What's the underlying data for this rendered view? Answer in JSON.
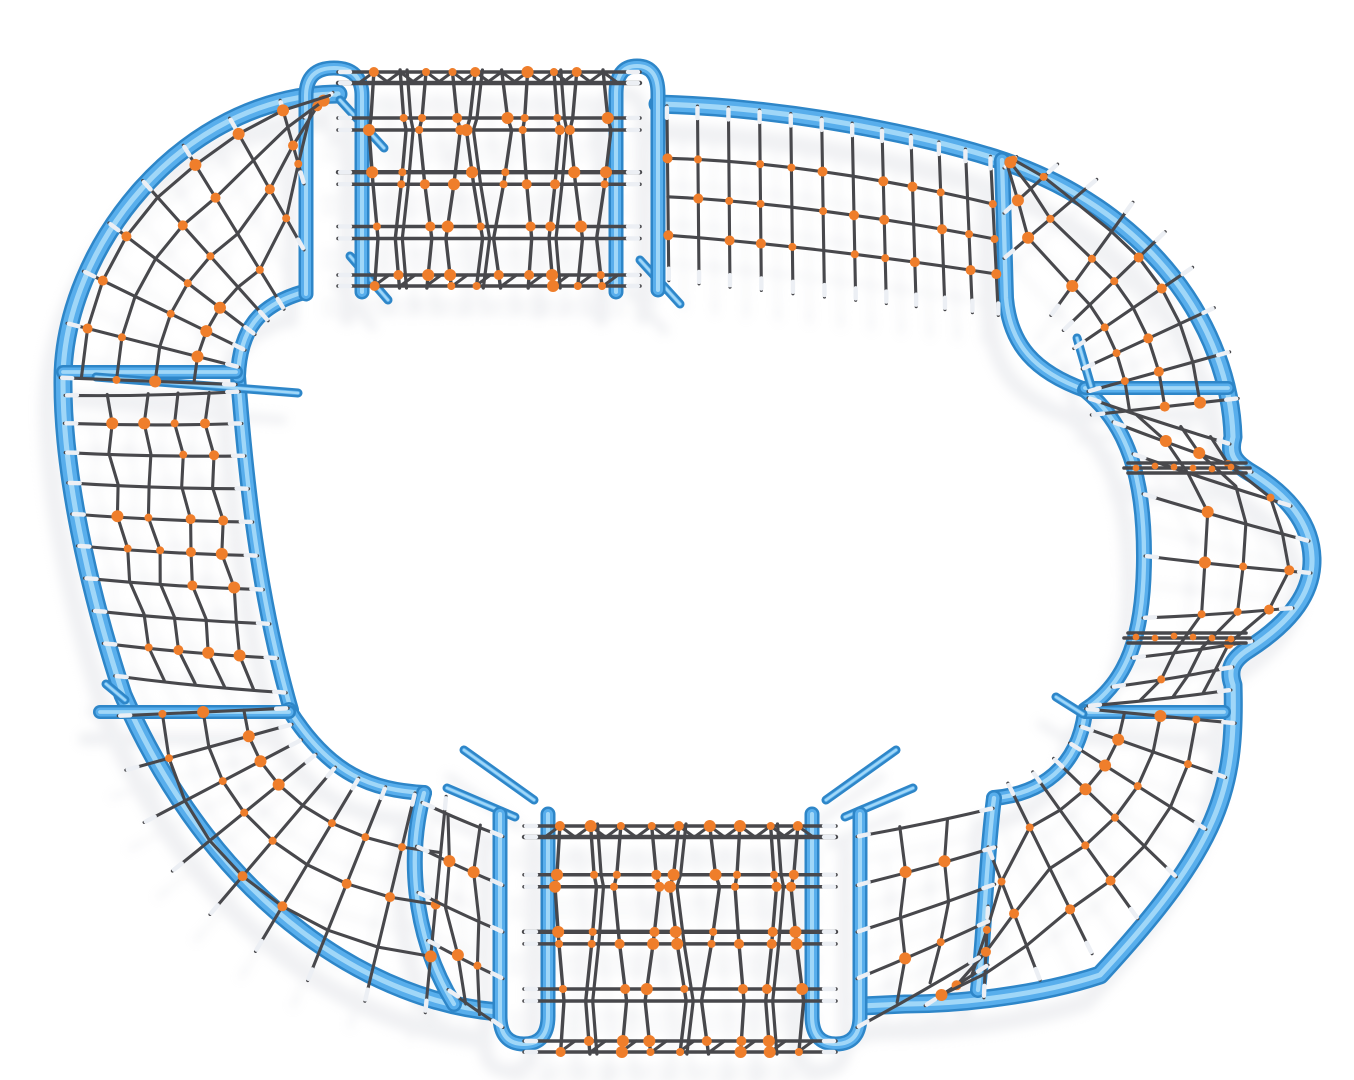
{
  "scene": {
    "description": "Top-down 3D product render of a closed-loop rope climbing playground structure: blue steel tube frame shaped like a rounded oval track, filled with dark grey climbing-rope nets joined by orange connectors, standing on a plain white ground with soft shadows.",
    "background_color": "#ffffff"
  },
  "palette": {
    "tube_edge": "#2e86c8",
    "tube_mid": "#58aeec",
    "tube_highlight": "#a9dbf9",
    "rope": "#48484c",
    "connector": "#ef7e2b",
    "ferrule": "#eceff4",
    "shadow_tint": "#b4b8c2"
  },
  "components": [
    {
      "name": "top-left-corner-net",
      "type": "quarter-circle radial rope net"
    },
    {
      "name": "top-net-tunnel",
      "type": "raised net tunnel with blue end arches"
    },
    {
      "name": "top-right-traverse-net",
      "type": "slanted flat rope net panel"
    },
    {
      "name": "top-right-corner-net",
      "type": "quarter-circle radial rope net"
    },
    {
      "name": "right-wave-net",
      "type": "outward-bulging curved rope net"
    },
    {
      "name": "bottom-right-corner-net",
      "type": "quarter-circle radial rope net"
    },
    {
      "name": "bottom-right-side-net",
      "type": "curved vertical rope net panel"
    },
    {
      "name": "bottom-net-tunnel",
      "type": "net tunnel with blue end arches"
    },
    {
      "name": "bottom-left-side-net",
      "type": "curved vertical rope net panel"
    },
    {
      "name": "bottom-left-corner-net",
      "type": "quarter-circle radial rope net"
    },
    {
      "name": "left-traverse-net",
      "type": "long curved rope net panel with crossbars"
    }
  ]
}
